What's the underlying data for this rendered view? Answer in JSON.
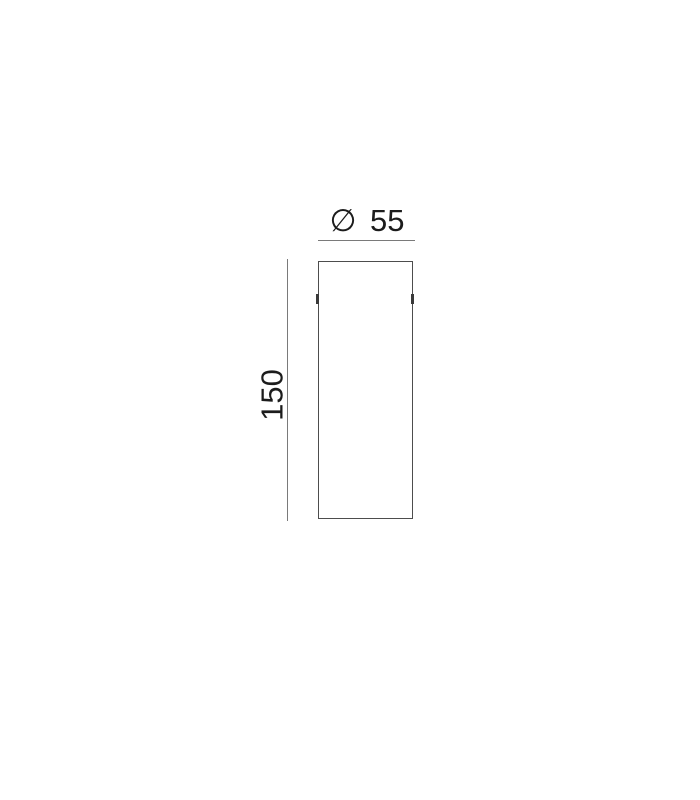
{
  "drawing": {
    "dimensions": {
      "diameter_label": "∅ 55",
      "height_label": "150"
    },
    "colors": {
      "background": "#ffffff",
      "outline": "#4d4d4d",
      "dimension_line": "#7a7a7a",
      "text": "#1c1c1c",
      "notch": "#3a3a3a"
    },
    "icons": {
      "diameter_symbol": "∅"
    }
  }
}
